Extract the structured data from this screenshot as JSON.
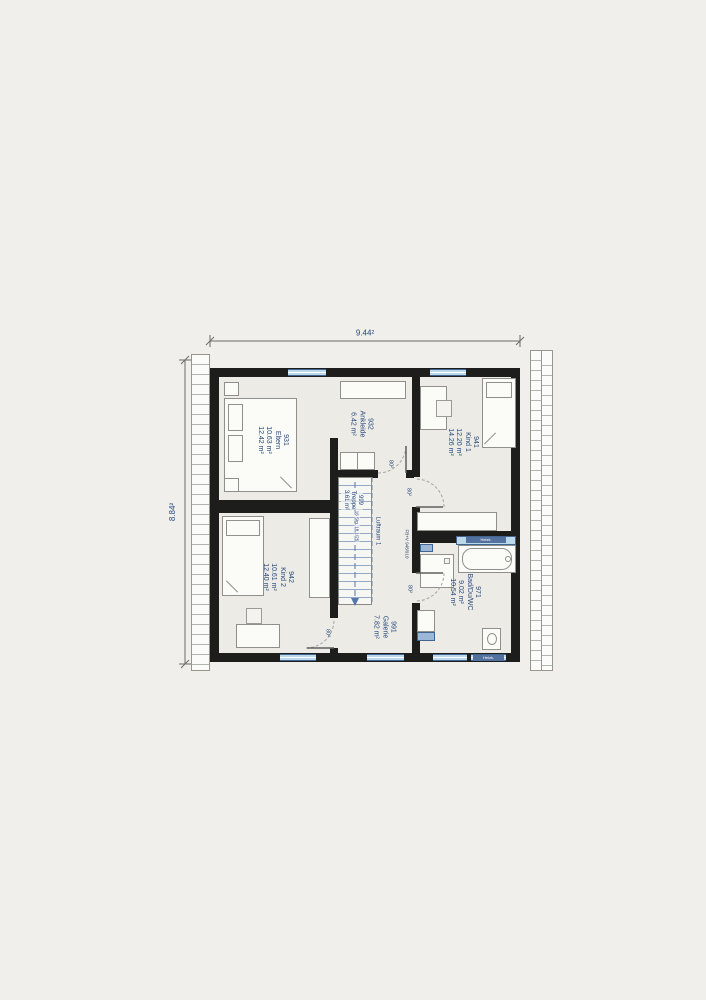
{
  "plan": {
    "dimensions": {
      "width_label": "9.44²",
      "height_label": "8.84²"
    },
    "rooms": {
      "eltern": {
        "number": "931",
        "name": "Eltern",
        "area_living": "10.63 m²",
        "area_floor": "12.42 m²"
      },
      "ankleide": {
        "number": "932",
        "name": "Ankleide",
        "area_living": "6.42 m²"
      },
      "kind1": {
        "number": "941",
        "name": "Kind 1",
        "area_living": "12.20 m²",
        "area_floor": "14.26 m²"
      },
      "kind2": {
        "number": "942",
        "name": "Kind 2",
        "area_living": "10.61 m²",
        "area_floor": "12.40 m²"
      },
      "treppe": {
        "number": "999",
        "name": "Treppe",
        "area_living": "3.61 m²",
        "steps_note": "16 Stg. 18,1/25"
      },
      "galerie": {
        "number": "991",
        "name": "Galerie",
        "area_living": "7.82 m²"
      },
      "bad": {
        "number": "971",
        "name": "Bad/Du/WC",
        "area_living": "9.02 m²",
        "area_floor": "10.54 m²"
      }
    },
    "annotations": {
      "void_label": "Luftraum 1",
      "railing_note": "FB+V 948/910",
      "door_width": "80²",
      "fixture_band": "Heizk."
    },
    "colors": {
      "wall": "#1d1d1c",
      "window_fill": "#bcd9ec",
      "window_stroke": "#41658e",
      "label_text": "#26497b",
      "floor": "#edebe6",
      "background": "#f1efec",
      "fixture_band": "#52719f"
    }
  }
}
